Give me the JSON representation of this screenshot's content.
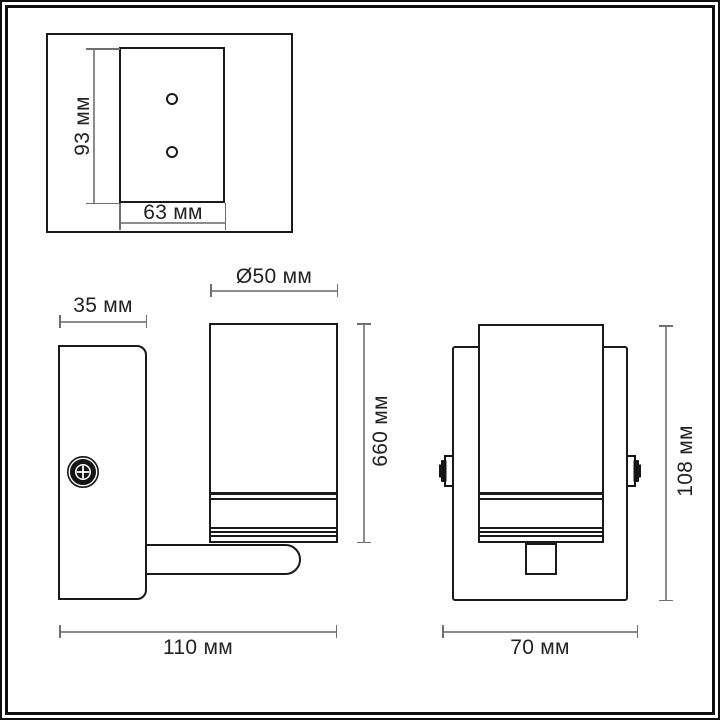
{
  "drawing": {
    "type": "wall-lamp-technical-drawing",
    "units": "мм"
  },
  "colors": {
    "background": "#ffffff",
    "outline": "#1a1a1a",
    "dimension_line": "#8c8c8c",
    "text": "#222222"
  },
  "icons": {
    "screw": "screw-icon",
    "knob_left": "knob-left-icon",
    "knob_right": "knob-right-icon"
  },
  "views": {
    "mounting_plate": {
      "height_dim": "93 мм",
      "width_dim": "63 мм"
    },
    "side": {
      "plate_depth_dim": "35 мм",
      "shade_diameter_dim": "Ø50 мм",
      "shade_height_dim": "660 мм",
      "overall_depth_dim": "110 мм"
    },
    "front": {
      "overall_height_dim": "108 мм",
      "overall_width_dim": "70 мм"
    }
  }
}
